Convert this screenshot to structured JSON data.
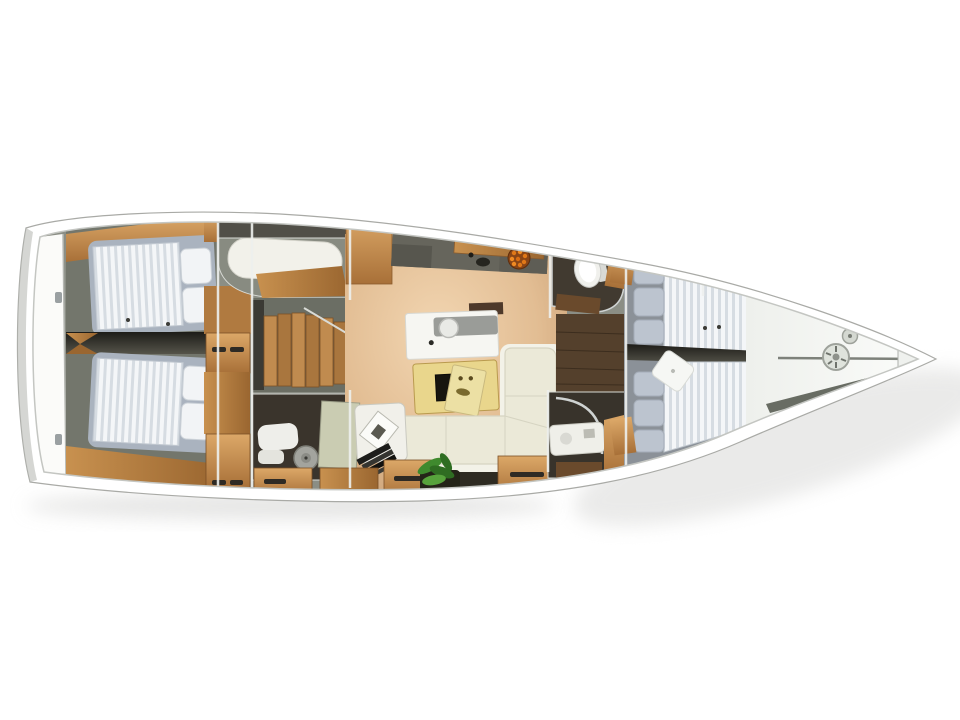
{
  "image": {
    "kind": "3D rendered sailing-yacht interior layout, top-down view",
    "orientation": "bow pointing right, stern at left",
    "background": "white"
  },
  "colors": {
    "background": "#ffffff",
    "hull_white": "#ffffff",
    "hull_edge": "#a9aaa6",
    "shadow": "#d2d2d0",
    "interior_base": "#8b8e85",
    "cabin_floor": "#73766c",
    "dark_room": "#3a342c",
    "corridor_wood": "#54402c",
    "wood_light": "#dca868",
    "wood_mid": "#b97f44",
    "wood_dark": "#8a5a2b",
    "salon_floor_hi": "#f2d6b2",
    "salon_floor_lo": "#c89e74",
    "counter_charcoal": "#66655c",
    "mattress_stripe": "#f4f6f8",
    "mattress_gap": "#d6dce2",
    "mattress_border": "#aab3bf",
    "pillow_white": "#f2f4f6",
    "pillow_grey": "#bcc4cf",
    "sofa_cream": "#ebe9d8",
    "sofa_edge": "#d6d4c2",
    "table_wood": "#e9d68c",
    "table_inset": "#17150f",
    "plant_green": "#3f8a2e",
    "plant_green_dark": "#2f6d22",
    "plant_pot": "#242418",
    "fruit_bowl": "#8a4516",
    "fruit_orange": "#e07818",
    "chrome": "#cfd3d2",
    "fixture_white": "#f0f0ec",
    "bow_deck": "#f7f8f6",
    "bow_recess": "#686c63",
    "divider_dark": "#23221e"
  },
  "vessel": {
    "hull": "white sailboat hull, pointed bow at right, flat transom at left",
    "rooms": [
      {
        "id": "swim-platform",
        "label": "stern transom / swim platform with two latch fittings"
      },
      {
        "id": "aft-cabin-port",
        "label": "aft double cabin (top) – striped mattress, two white pillows at right"
      },
      {
        "id": "aft-cabin-starboard",
        "label": "aft double cabin (bottom) – striped mattress, two white pillows at right"
      },
      {
        "id": "aft-lockers",
        "label": "wooden locker column with dark drawer handles"
      },
      {
        "id": "technical-room",
        "label": "single white berth cushion in top-centre room with wood sole inset"
      },
      {
        "id": "companionway",
        "label": "wooden companionway stairs descending aft"
      },
      {
        "id": "aft-head",
        "label": "aft bathroom (bottom centre) with round grey fixture and white towels"
      },
      {
        "id": "salon",
        "label": "main salon with warm light-oak floor"
      },
      {
        "id": "galley",
        "label": "galley – charcoal worktop, sink, wooden board, bowl of oranges"
      },
      {
        "id": "chart-station",
        "label": "white chart table with grey instrument panel and round stool"
      },
      {
        "id": "salon-table",
        "label": "pale-wood salon table with dark inlay and magazine on top"
      },
      {
        "id": "sofa",
        "label": "L-shaped cream sofa wrapping the table"
      },
      {
        "id": "reading-seat",
        "label": "white seat with tilted picture frame and stack of dark books"
      },
      {
        "id": "plant",
        "label": "green potted plant at salon entry"
      },
      {
        "id": "port-head",
        "label": "forward bathroom (top) with white toilet and wood shelf"
      },
      {
        "id": "corridor",
        "label": "corridor with dark wood sole between heads"
      },
      {
        "id": "shower-room",
        "label": "shower room (bottom) with white vanity and chrome enclosure"
      },
      {
        "id": "forward-cabin",
        "label": "owner cabin – two striped berths, grey pillow stacks, tilted white cushion, wood foot boards"
      },
      {
        "id": "bow-deck",
        "label": "white bow deck with windlass drums and anchor-locker recess"
      }
    ]
  }
}
